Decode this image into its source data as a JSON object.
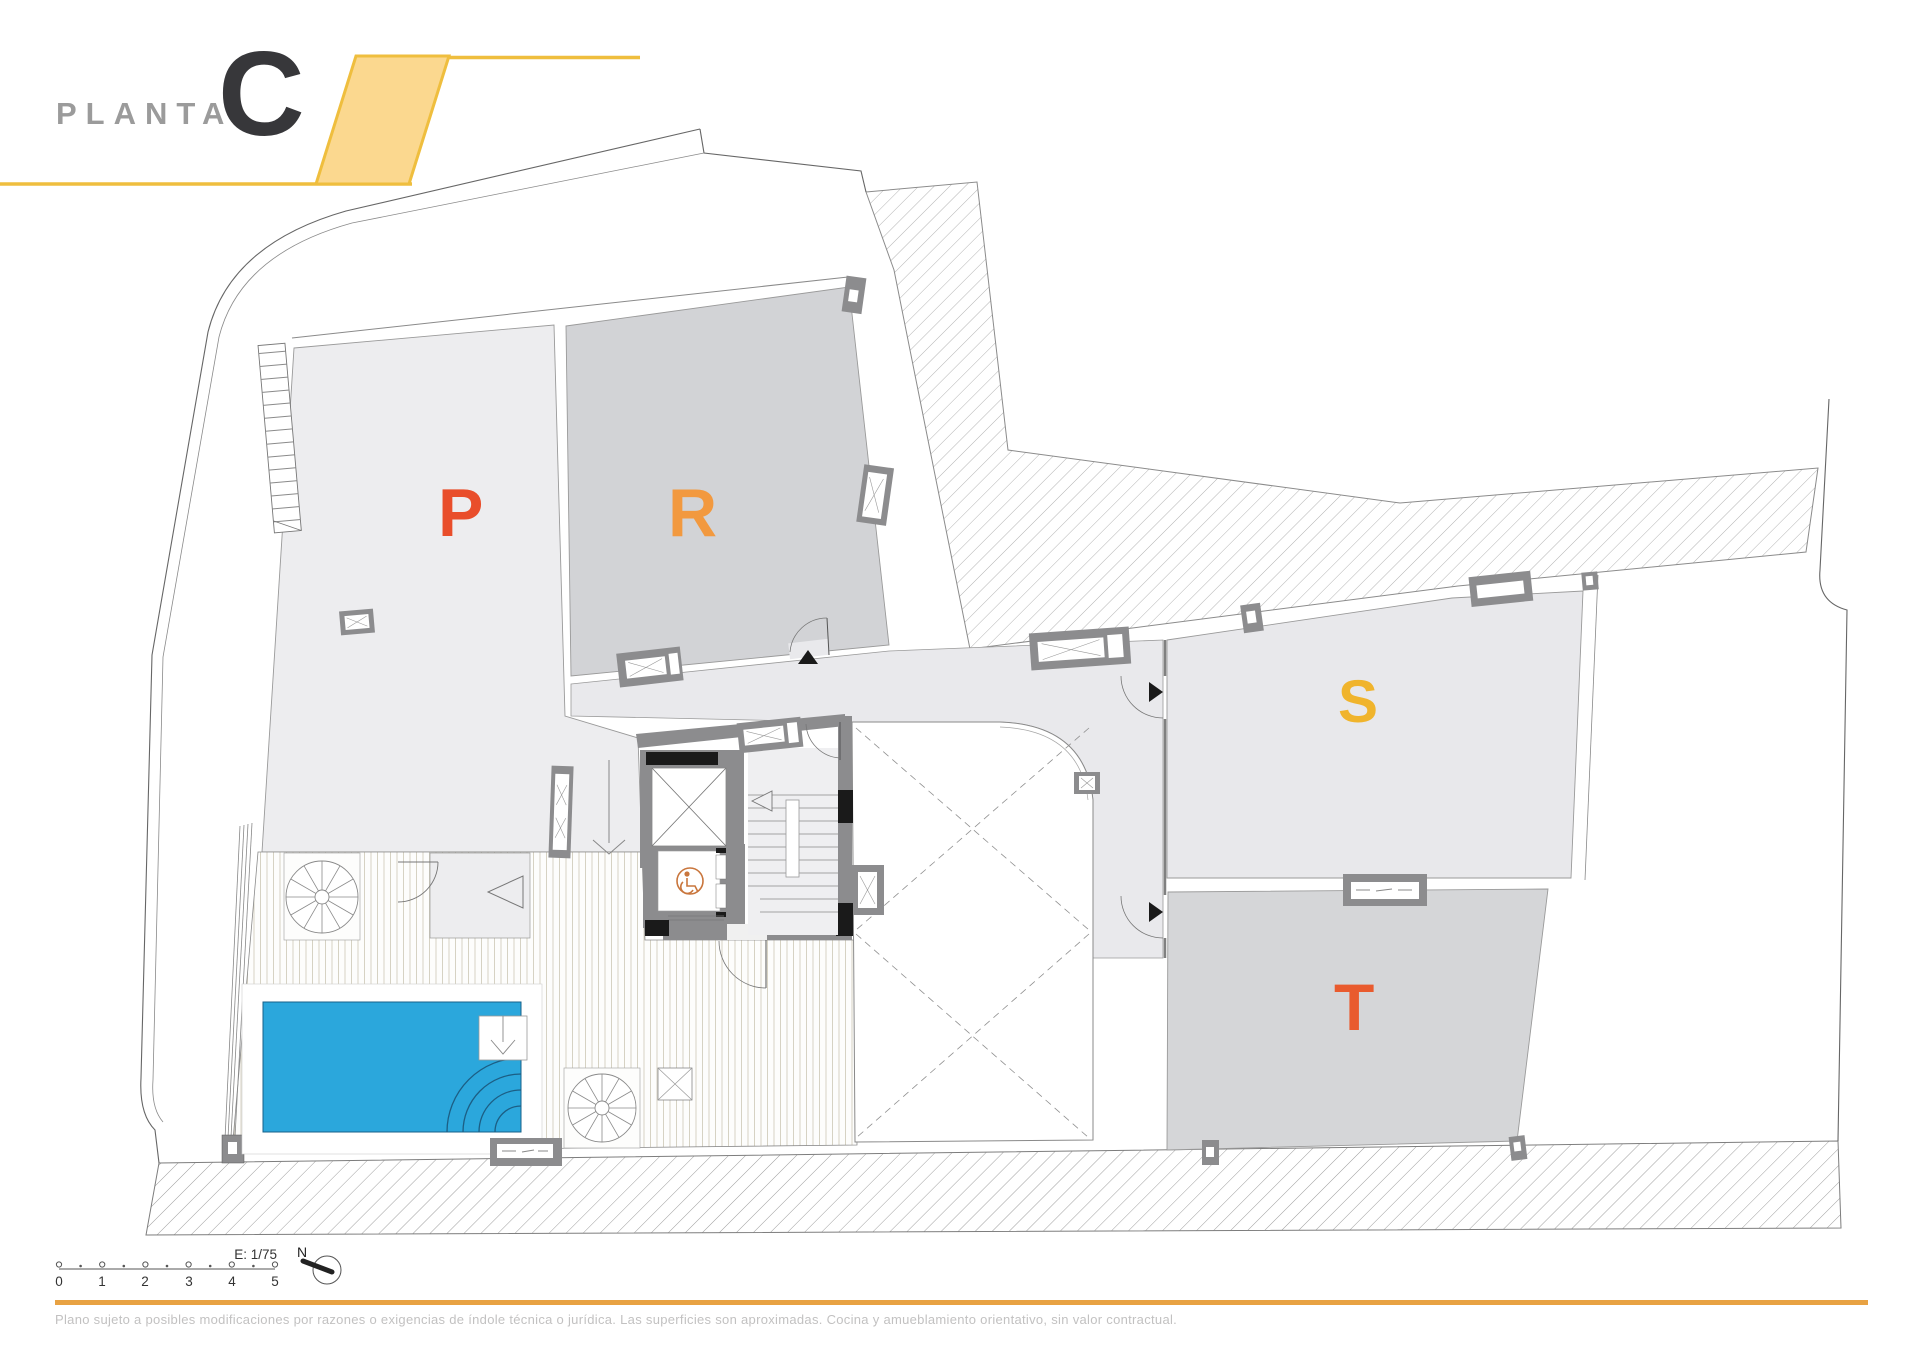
{
  "header": {
    "label": "PLANTA",
    "floor_letter": "C",
    "accent_color": "#EFBE3E",
    "accent_fill": "#FBD88F"
  },
  "rooms": {
    "p": {
      "label": "P",
      "color": "#E94E2B",
      "fill": "#EDEDEF"
    },
    "r": {
      "label": "R",
      "color": "#F2993F",
      "fill": "#D2D3D6"
    },
    "s": {
      "label": "S",
      "color": "#F0B42C",
      "fill": "#E8E8EB"
    },
    "t": {
      "label": "T",
      "color": "#E95B2E",
      "fill": "#D5D6D8"
    }
  },
  "pool": {
    "water_color": "#2BA7DC"
  },
  "icons": {
    "wheelchair": "wheelchair-accessible-elevator",
    "north_arrow": "compass-north",
    "spiral_stairs": "spiral-staircase",
    "stairs": "staircase"
  },
  "footer": {
    "scale": {
      "label": "E: 1/75",
      "marks": [
        "0",
        "1",
        "2",
        "3",
        "4",
        "5"
      ]
    },
    "north_label": "N",
    "rule_color": "#E8A243",
    "disclaimer": "Plano sujeto a posibles modificaciones por razones o exigencias de índole técnica o jurídica. Las superficies son aproximadas. Cocina y amueblamiento orientativo, sin valor contractual."
  }
}
